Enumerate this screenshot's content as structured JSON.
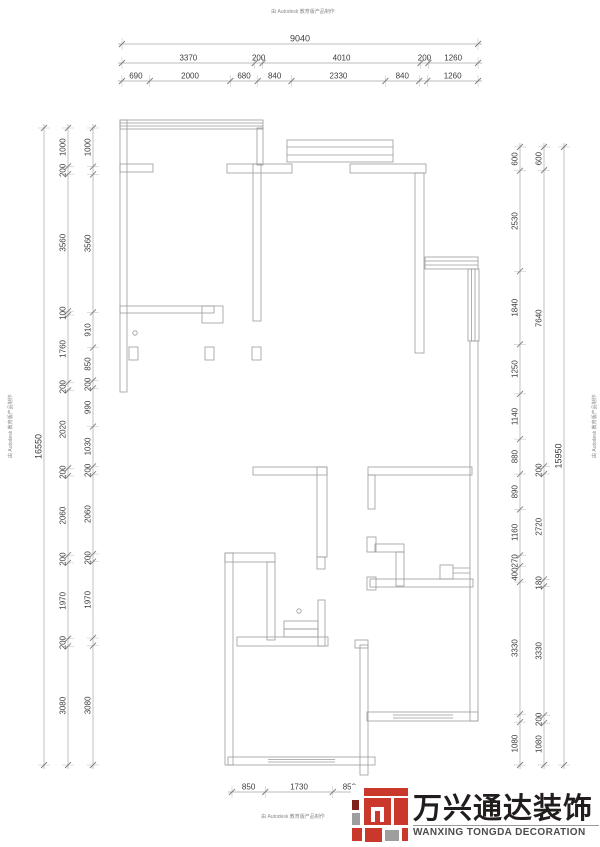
{
  "stamps": {
    "text": "由 Autodesk 教育版产品制作"
  },
  "logo": {
    "cn": "万兴通达装饰",
    "en": "WANXING TONGDA DECORATION",
    "colors": {
      "red": "#c9382b",
      "gray": "#9e9e9e",
      "dark": "#7e211a",
      "cn_text": "#211d1c",
      "en_text": "#4c4c4c"
    }
  },
  "drawing": {
    "line_color": "#a6a6a6",
    "wall_color": "#9b9b9b",
    "text_color": "#3c3c3c"
  },
  "dimension_chains": [
    {
      "id": "top-total",
      "dir": "h",
      "pos": 44,
      "from": 122,
      "to": 478,
      "fs": 9,
      "segments": [
        {
          "len": 9040,
          "label": "9040"
        }
      ]
    },
    {
      "id": "top-middle",
      "dir": "h",
      "pos": 63,
      "from": 122,
      "to": 478,
      "fs": 8,
      "segments": [
        {
          "len": 3370,
          "label": "3370"
        },
        {
          "len": 200,
          "label": "200"
        },
        {
          "len": 4010,
          "label": "4010"
        },
        {
          "len": 200,
          "label": "200"
        },
        {
          "len": 1260,
          "label": "1260"
        }
      ]
    },
    {
      "id": "top-inner",
      "dir": "h",
      "pos": 81,
      "from": 122,
      "to": 478,
      "fs": 8,
      "segments": [
        {
          "len": 690,
          "label": "690"
        },
        {
          "len": 2000,
          "label": "2000"
        },
        {
          "len": 680,
          "label": "680"
        },
        {
          "len": 840,
          "label": "840"
        },
        {
          "len": 2330,
          "label": "2330"
        },
        {
          "len": 840,
          "label": "840"
        },
        {
          "len": 200,
          "label": ""
        },
        {
          "len": 1260,
          "label": "1260"
        }
      ]
    },
    {
      "id": "left-total",
      "dir": "v",
      "pos": 44,
      "from": 128,
      "to": 765,
      "fs": 9,
      "segments": [
        {
          "len": 16550,
          "label": "16550"
        }
      ]
    },
    {
      "id": "left-middle",
      "dir": "v",
      "pos": 68,
      "from": 128,
      "to": 765,
      "fs": 8,
      "segments": [
        {
          "len": 1000,
          "label": "1000"
        },
        {
          "len": 200,
          "label": "200"
        },
        {
          "len": 3560,
          "label": "3560"
        },
        {
          "len": 100,
          "label": "100"
        },
        {
          "len": 1760,
          "label": "1760"
        },
        {
          "len": 200,
          "label": "200"
        },
        {
          "len": 2020,
          "label": "2020"
        },
        {
          "len": 200,
          "label": "200"
        },
        {
          "len": 2060,
          "label": "2060"
        },
        {
          "len": 200,
          "label": "200"
        },
        {
          "len": 1970,
          "label": "1970"
        },
        {
          "len": 200,
          "label": "200"
        },
        {
          "len": 3080,
          "label": "3080"
        }
      ]
    },
    {
      "id": "left-inner",
      "dir": "v",
      "pos": 93,
      "from": 128,
      "to": 765,
      "fs": 8,
      "segments": [
        {
          "len": 1000,
          "label": "1000"
        },
        {
          "len": 200,
          "label": ""
        },
        {
          "len": 3560,
          "label": "3560"
        },
        {
          "len": 910,
          "label": "910"
        },
        {
          "len": 850,
          "label": "850"
        },
        {
          "len": 200,
          "label": "200"
        },
        {
          "len": 990,
          "label": "990"
        },
        {
          "len": 1030,
          "label": "1030"
        },
        {
          "len": 200,
          "label": "200"
        },
        {
          "len": 2060,
          "label": "2060"
        },
        {
          "len": 200,
          "label": "200"
        },
        {
          "len": 1970,
          "label": "1970"
        },
        {
          "len": 200,
          "label": ""
        },
        {
          "len": 3080,
          "label": "3080"
        }
      ]
    },
    {
      "id": "right-inner",
      "dir": "v",
      "pos": 520,
      "from": 147,
      "to": 765,
      "fs": 8,
      "segments": [
        {
          "len": 600,
          "label": "600"
        },
        {
          "len": 2530,
          "label": "2530"
        },
        {
          "len": 1840,
          "label": "1840"
        },
        {
          "len": 1250,
          "label": "1250"
        },
        {
          "len": 1140,
          "label": "1140"
        },
        {
          "len": 880,
          "label": "880"
        },
        {
          "len": 890,
          "label": "890"
        },
        {
          "len": 1160,
          "label": "1160"
        },
        {
          "len": 270,
          "label": "270"
        },
        {
          "len": 400,
          "label": "400"
        },
        {
          "len": 3330,
          "label": "3330"
        },
        {
          "len": 200,
          "label": ""
        },
        {
          "len": 1080,
          "label": "1080"
        }
      ]
    },
    {
      "id": "right-middle",
      "dir": "v",
      "pos": 544,
      "from": 147,
      "to": 765,
      "fs": 8,
      "segments": [
        {
          "len": 600,
          "label": "600"
        },
        {
          "len": 7640,
          "label": "7640"
        },
        {
          "len": 200,
          "label": "200"
        },
        {
          "len": 2720,
          "label": "2720"
        },
        {
          "len": 180,
          "label": "180"
        },
        {
          "len": 3330,
          "label": "3330"
        },
        {
          "len": 200,
          "label": "200"
        },
        {
          "len": 1080,
          "label": "1080"
        }
      ]
    },
    {
      "id": "right-total",
      "dir": "v",
      "pos": 564,
      "from": 147,
      "to": 765,
      "fs": 9,
      "segments": [
        {
          "len": 15950,
          "label": "15950"
        }
      ]
    },
    {
      "id": "bottom",
      "dir": "h",
      "pos": 792,
      "from": 232,
      "to": 366,
      "fs": 8,
      "segments": [
        {
          "len": 850,
          "label": "850"
        },
        {
          "len": 1730,
          "label": "1730"
        },
        {
          "len": 850,
          "label": "850"
        }
      ]
    }
  ]
}
